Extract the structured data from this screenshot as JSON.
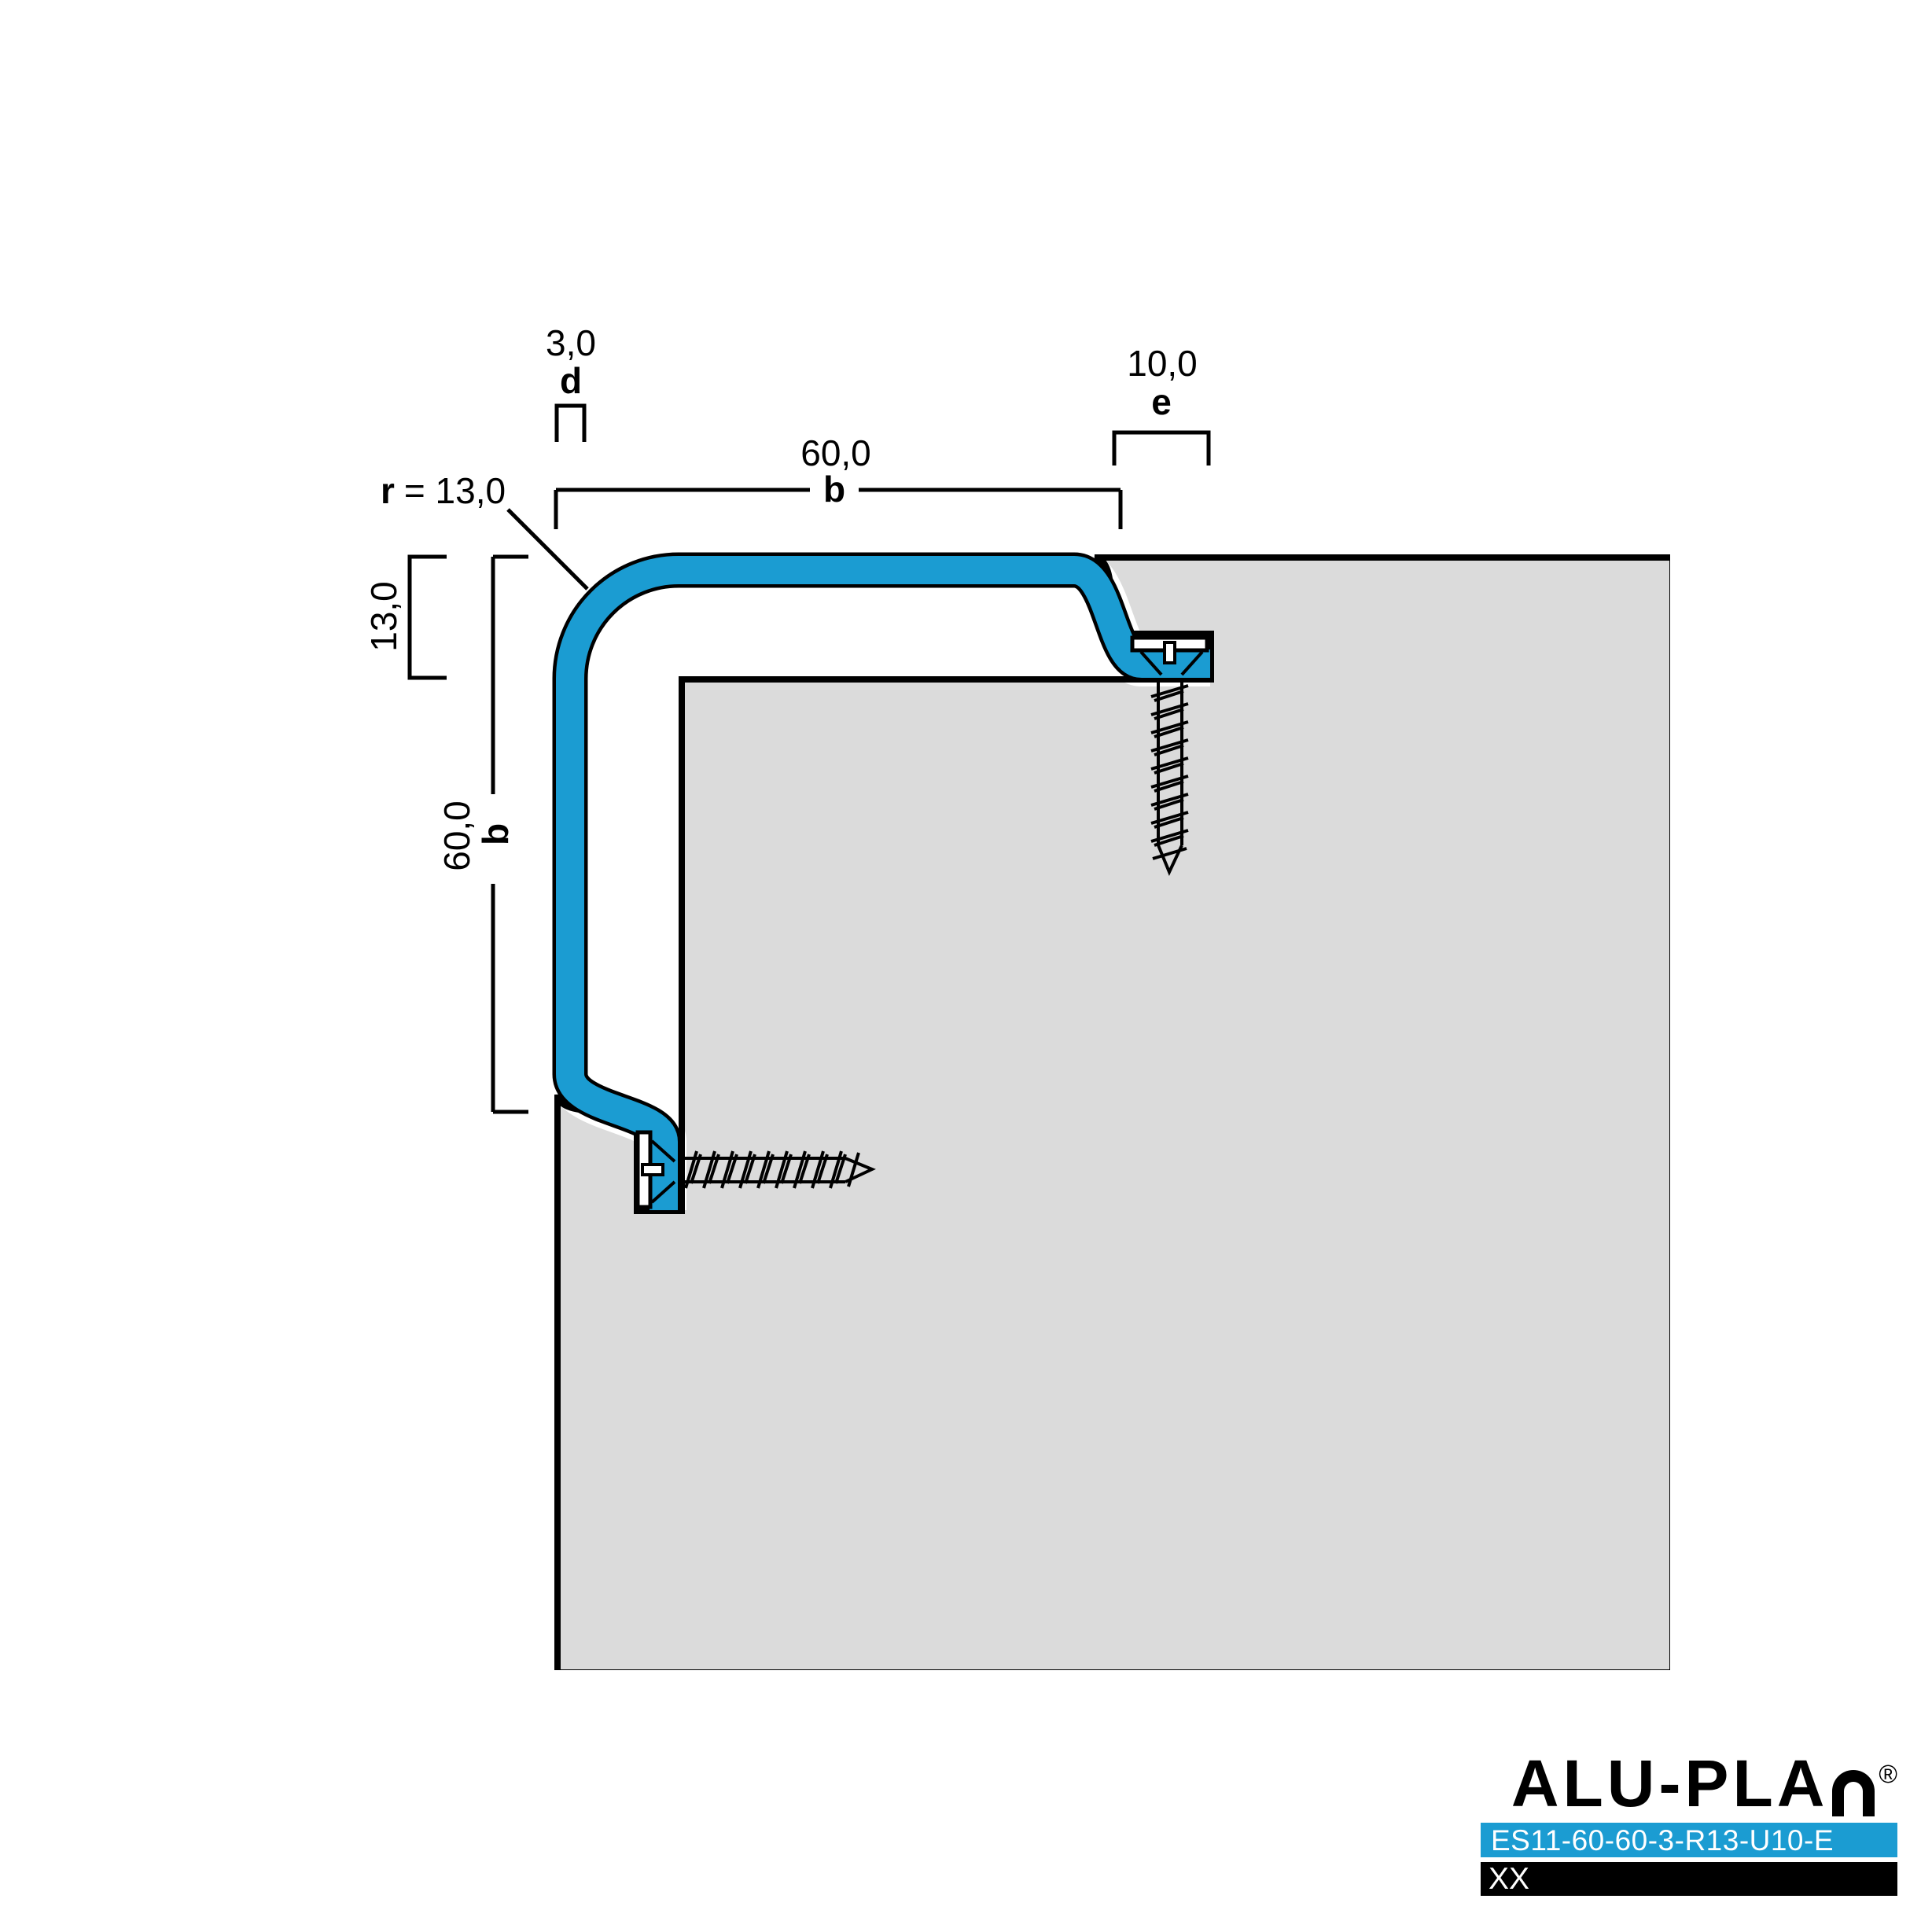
{
  "dims": {
    "d_value": "3,0",
    "d_label": "d",
    "e_value": "10,0",
    "e_label": "e",
    "b_top_value": "60,0",
    "b_top_label": "b",
    "b_left_value": "60,0",
    "b_left_label": "b",
    "return_value": "13,0",
    "r_name": "r",
    "r_rest": "= 13,0"
  },
  "colors": {
    "profile_blue": "#1B9CD2",
    "substrate_gray": "#DBDBDB",
    "outline_black": "#000000"
  },
  "logo": {
    "brand": "ALU-PLA",
    "registered": "®",
    "product_code": "ES11-60-60-3-R13-U10-E",
    "variant": "XX"
  }
}
